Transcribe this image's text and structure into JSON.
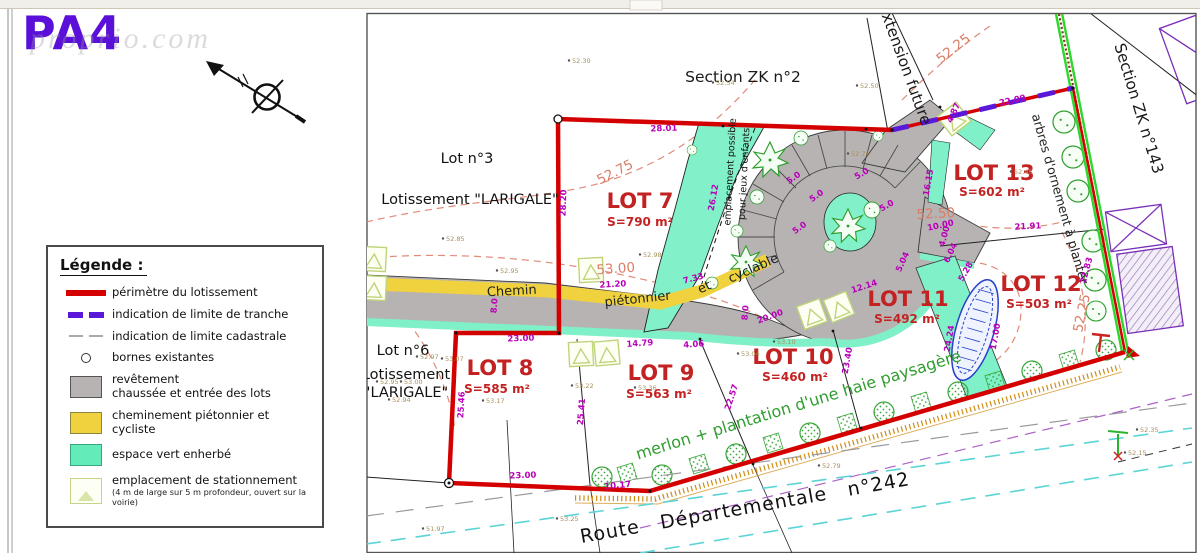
{
  "page": {
    "code": "PA4",
    "watermark": "proprio.com"
  },
  "legend": {
    "title": "Légende :",
    "items": [
      {
        "label": "périmètre du lotissement"
      },
      {
        "label": "indication de limite de tranche"
      },
      {
        "label": "indication de limite cadastrale"
      },
      {
        "label": "bornes existantes"
      },
      {
        "label": "revêtement",
        "label2": "chaussée et entrée des lots"
      },
      {
        "label": "cheminement piétonnier et cycliste"
      },
      {
        "label": "espace vert enherbé"
      },
      {
        "label": "emplacement de stationnement",
        "note": "(4 m de large sur 5 m profondeur, ouvert sur la voirie)"
      }
    ]
  },
  "plan": {
    "lots": [
      {
        "name": "LOT 7",
        "surface": "S=790 m²"
      },
      {
        "name": "LOT 8",
        "surface": "S=585 m²"
      },
      {
        "name": "LOT 9",
        "surface": "S=563 m²"
      },
      {
        "name": "LOT 10",
        "surface": "S=460 m²"
      },
      {
        "name": "LOT 11",
        "surface": "S=492 m²"
      },
      {
        "name": "LOT 12",
        "surface": "S=503 m²"
      },
      {
        "name": "LOT 13",
        "surface": "S=602 m²"
      }
    ],
    "labels": [
      {
        "t": "Section ZK n°2",
        "x": 743,
        "y": 82,
        "c": "sec"
      },
      {
        "t": "Extension future",
        "x": 900,
        "y": 66,
        "r": 70,
        "c": "sec"
      },
      {
        "t": "Section ZK n°143",
        "x": 1134,
        "y": 110,
        "r": 73,
        "c": "sec"
      },
      {
        "t": "arbres d'ornement à planter",
        "x": 1056,
        "y": 200,
        "r": 74,
        "c": "arb"
      },
      {
        "t": "Lot n°3",
        "x": 467,
        "y": 163,
        "c": "blk"
      },
      {
        "t": "Lotissement \"LARIGALE\"",
        "x": 470,
        "y": 204,
        "c": "blk"
      },
      {
        "t": "Lot n°6",
        "x": 403,
        "y": 355,
        "c": "blk"
      },
      {
        "t": "Lotissement",
        "x": 406,
        "y": 379,
        "c": "blk"
      },
      {
        "t": "\"LARIGALE\"",
        "x": 406,
        "y": 397,
        "c": "blk"
      },
      {
        "t": "LOT 7",
        "x": 640,
        "y": 208,
        "c": "lot"
      },
      {
        "t": "S=790 m²",
        "x": 640,
        "y": 226,
        "c": "area"
      },
      {
        "t": "LOT 8",
        "x": 500,
        "y": 375,
        "c": "lot"
      },
      {
        "t": "S=585 m²",
        "x": 497,
        "y": 393,
        "c": "area"
      },
      {
        "t": "LOT 9",
        "x": 661,
        "y": 380,
        "c": "lot"
      },
      {
        "t": "S=563 m²",
        "x": 659,
        "y": 398,
        "c": "area"
      },
      {
        "t": "LOT 10",
        "x": 793,
        "y": 364,
        "c": "lot"
      },
      {
        "t": "S=460 m²",
        "x": 795,
        "y": 381,
        "c": "area"
      },
      {
        "t": "LOT 11",
        "x": 908,
        "y": 306,
        "c": "lot"
      },
      {
        "t": "S=492 m²",
        "x": 907,
        "y": 323,
        "c": "area"
      },
      {
        "t": "LOT 12",
        "x": 1041,
        "y": 291,
        "c": "lot"
      },
      {
        "t": "S=503 m²",
        "x": 1039,
        "y": 308,
        "c": "area"
      },
      {
        "t": "LOT 13",
        "x": 994,
        "y": 180,
        "c": "lot"
      },
      {
        "t": "S=602 m²",
        "x": 992,
        "y": 196,
        "c": "area"
      },
      {
        "t": "Chemin",
        "x": 512,
        "y": 295,
        "r": -3,
        "c": "chem"
      },
      {
        "t": "piétonnier",
        "x": 638,
        "y": 303,
        "r": -6,
        "c": "chem"
      },
      {
        "t": "et",
        "x": 706,
        "y": 291,
        "r": -24,
        "c": "chem"
      },
      {
        "t": "cyclable",
        "x": 755,
        "y": 272,
        "r": -24,
        "c": "chem"
      },
      {
        "t": "emplacement possible",
        "x": 733,
        "y": 172,
        "r": -87,
        "c": "jeux"
      },
      {
        "t": "pour jeux d'enfants",
        "x": 747,
        "y": 174,
        "r": -87,
        "c": "jeux"
      },
      {
        "t": "merlon + plantation d'une haie paysagère",
        "x": 800,
        "y": 410,
        "r": -17,
        "c": "merlon"
      },
      {
        "t": "Route Départementale n°242",
        "x": 746,
        "y": 514,
        "r": -10,
        "c": "route"
      },
      {
        "t": "52.75",
        "x": 617,
        "y": 176,
        "r": -27,
        "c": "cont"
      },
      {
        "t": "53.00",
        "x": 616,
        "y": 273,
        "r": -4,
        "c": "cont"
      },
      {
        "t": "52.50",
        "x": 936,
        "y": 218,
        "r": -3,
        "c": "cont"
      },
      {
        "t": "52.25",
        "x": 956,
        "y": 52,
        "r": -38,
        "c": "cont"
      },
      {
        "t": "52.25",
        "x": 1086,
        "y": 314,
        "r": -78,
        "c": "cont"
      },
      {
        "t": "28.01",
        "x": 664,
        "y": 131,
        "r": -2,
        "c": "dim"
      },
      {
        "t": "22.09",
        "x": 1013,
        "y": 103,
        "r": -12,
        "c": "dim"
      },
      {
        "t": "4.87",
        "x": 956,
        "y": 114,
        "r": -65,
        "c": "dim"
      },
      {
        "t": "28.20",
        "x": 566,
        "y": 203,
        "r": -88,
        "c": "dim"
      },
      {
        "t": "26.12",
        "x": 716,
        "y": 198,
        "r": -80,
        "c": "dim"
      },
      {
        "t": "21.20",
        "x": 613,
        "y": 287,
        "r": -3,
        "c": "dim"
      },
      {
        "t": "7.33",
        "x": 694,
        "y": 281,
        "r": -15,
        "c": "dim"
      },
      {
        "t": "23.00",
        "x": 521,
        "y": 341,
        "r": -2,
        "c": "dim"
      },
      {
        "t": "8.0",
        "x": 497,
        "y": 306,
        "r": -85,
        "c": "dim"
      },
      {
        "t": "25.46",
        "x": 464,
        "y": 405,
        "r": -87,
        "c": "dim"
      },
      {
        "t": "25.41",
        "x": 584,
        "y": 412,
        "r": -85,
        "c": "dim"
      },
      {
        "t": "23.00",
        "x": 523,
        "y": 478,
        "r": -2,
        "c": "dim"
      },
      {
        "t": "10.17",
        "x": 618,
        "y": 488,
        "r": -6,
        "c": "dim"
      },
      {
        "t": "14.79",
        "x": 640,
        "y": 346,
        "r": -4,
        "c": "dim"
      },
      {
        "t": "4.06",
        "x": 694,
        "y": 347,
        "r": -4,
        "c": "dim"
      },
      {
        "t": "22.57",
        "x": 734,
        "y": 398,
        "r": -72,
        "c": "dim"
      },
      {
        "t": "23.40",
        "x": 850,
        "y": 361,
        "r": -80,
        "c": "dim"
      },
      {
        "t": "20.00",
        "x": 771,
        "y": 319,
        "r": -20,
        "c": "dim"
      },
      {
        "t": "12.14",
        "x": 865,
        "y": 289,
        "r": -18,
        "c": "dim"
      },
      {
        "t": "8.0",
        "x": 748,
        "y": 313,
        "r": -85,
        "c": "dim"
      },
      {
        "t": "5.0",
        "x": 795,
        "y": 180,
        "r": -35,
        "c": "dim"
      },
      {
        "t": "5.0",
        "x": 818,
        "y": 198,
        "r": -35,
        "c": "dim"
      },
      {
        "t": "5.0",
        "x": 863,
        "y": 176,
        "r": -30,
        "c": "dim"
      },
      {
        "t": "5.0",
        "x": 888,
        "y": 208,
        "r": -30,
        "c": "dim"
      },
      {
        "t": "5.0",
        "x": 801,
        "y": 230,
        "r": -35,
        "c": "d im"
      },
      {
        "t": "16.15",
        "x": 931,
        "y": 183,
        "r": -80,
        "c": "dim"
      },
      {
        "t": "10.00",
        "x": 941,
        "y": 228,
        "r": -12,
        "c": "dim"
      },
      {
        "t": "4.00",
        "x": 947,
        "y": 237,
        "r": -75,
        "c": "dim"
      },
      {
        "t": "21.91",
        "x": 1028,
        "y": 229,
        "r": -3,
        "c": "dim"
      },
      {
        "t": "5.04",
        "x": 905,
        "y": 263,
        "r": -65,
        "c": "dim"
      },
      {
        "t": "6.04",
        "x": 953,
        "y": 254,
        "r": -65,
        "c": "dim"
      },
      {
        "t": "5.28",
        "x": 968,
        "y": 273,
        "r": -60,
        "c": "dim"
      },
      {
        "t": "24.24",
        "x": 952,
        "y": 339,
        "r": -80,
        "c": "dim"
      },
      {
        "t": "17.00",
        "x": 998,
        "y": 337,
        "r": -80,
        "c": "dim"
      },
      {
        "t": "22.83",
        "x": 1089,
        "y": 271,
        "r": -75,
        "c": "dim"
      },
      {
        "t": "52.30",
        "x": 572,
        "y": 63,
        "c": "spot"
      },
      {
        "t": "52.54",
        "x": 716,
        "y": 85,
        "c": "spot"
      },
      {
        "t": "52.50",
        "x": 860,
        "y": 88,
        "c": "spot"
      },
      {
        "t": "52.85",
        "x": 446,
        "y": 241,
        "c": "spot"
      },
      {
        "t": "52.95",
        "x": 500,
        "y": 273,
        "c": "spot"
      },
      {
        "t": "52.98",
        "x": 643,
        "y": 257,
        "c": "spot"
      },
      {
        "t": "52.97",
        "x": 420,
        "y": 359,
        "c": "spot"
      },
      {
        "t": "53.07",
        "x": 445,
        "y": 361,
        "c": "spot"
      },
      {
        "t": "52.95",
        "x": 380,
        "y": 384,
        "c": "spot"
      },
      {
        "t": "53.00",
        "x": 404,
        "y": 384,
        "c": "spot"
      },
      {
        "t": "52.94",
        "x": 392,
        "y": 402,
        "c": "spot"
      },
      {
        "t": "53.17",
        "x": 486,
        "y": 403,
        "c": "spot"
      },
      {
        "t": "53.22",
        "x": 575,
        "y": 388,
        "c": "spot"
      },
      {
        "t": "53.36",
        "x": 638,
        "y": 390,
        "c": "spot"
      },
      {
        "t": "53.04",
        "x": 741,
        "y": 356,
        "c": "spot"
      },
      {
        "t": "53.10",
        "x": 777,
        "y": 344,
        "c": "spot"
      },
      {
        "t": "52.45",
        "x": 1014,
        "y": 174,
        "c": "spot"
      },
      {
        "t": "52.76",
        "x": 851,
        "y": 156,
        "c": "spot"
      },
      {
        "t": "51.97",
        "x": 426,
        "y": 531,
        "c": "spot"
      },
      {
        "t": "53.25",
        "x": 560,
        "y": 521,
        "c": "spot"
      },
      {
        "t": "52.79",
        "x": 822,
        "y": 468,
        "c": "spot"
      },
      {
        "t": "52.35",
        "x": 1140,
        "y": 432,
        "c": "spot"
      },
      {
        "t": "52.15",
        "x": 1128,
        "y": 455,
        "c": "spot"
      }
    ]
  }
}
